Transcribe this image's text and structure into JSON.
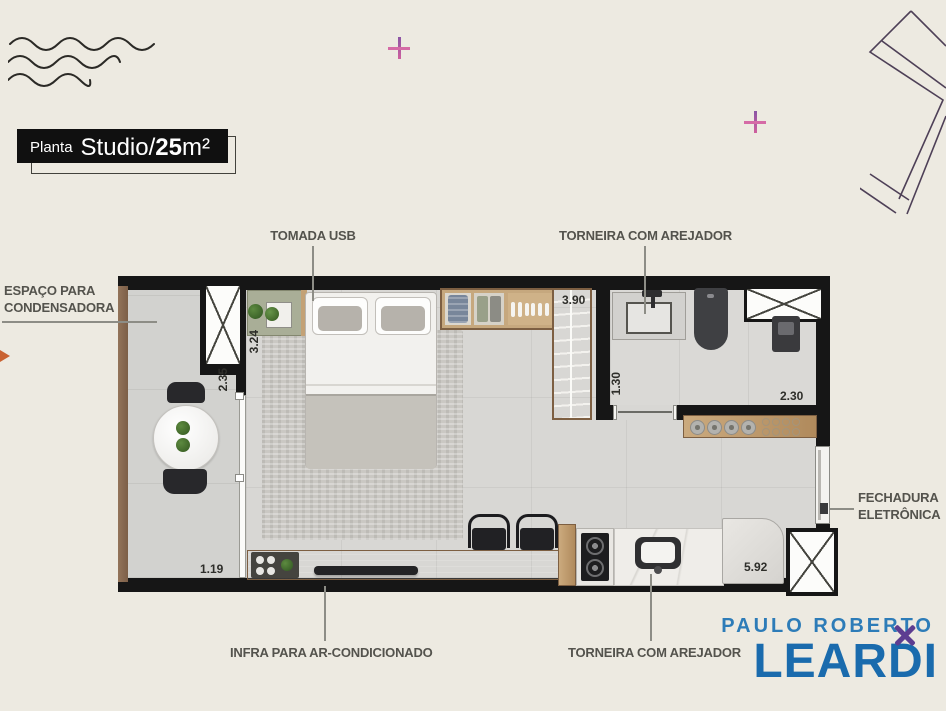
{
  "title": {
    "prefix": "Planta",
    "name": "Studio/",
    "area_value": "25",
    "area_unit": "m²"
  },
  "callouts": {
    "tomada_usb": "TOMADA USB",
    "torneira_arejador_top": "TORNEIRA COM AREJADOR",
    "espaco_condensadora_line1": "ESPAÇO PARA",
    "espaco_condensadora_line2": "CONDENSADORA",
    "fechadura_line1": "FECHADURA",
    "fechadura_line2": "ELETRÔNICA",
    "infra_ar_condicionado": "INFRA PARA AR-CONDICIONADO",
    "torneira_arejador_bottom": "TORNEIRA COM AREJADOR"
  },
  "dimensions": {
    "dim_324": "3.24",
    "dim_235": "2.35",
    "dim_119": "1.19",
    "dim_390": "3.90",
    "dim_130": "1.30",
    "dim_230": "2.30",
    "dim_592": "5.92"
  },
  "logo": {
    "line1": "PAULO ROBERTO",
    "line2": "LEARDI"
  },
  "colors": {
    "wall": "#161616",
    "logo_blue": "#1a6bad",
    "logo_light_blue": "#2d7cb8",
    "accent_pink": "#d0609e",
    "accent_purple": "#5d3d91",
    "accent_orange": "#c96231"
  }
}
